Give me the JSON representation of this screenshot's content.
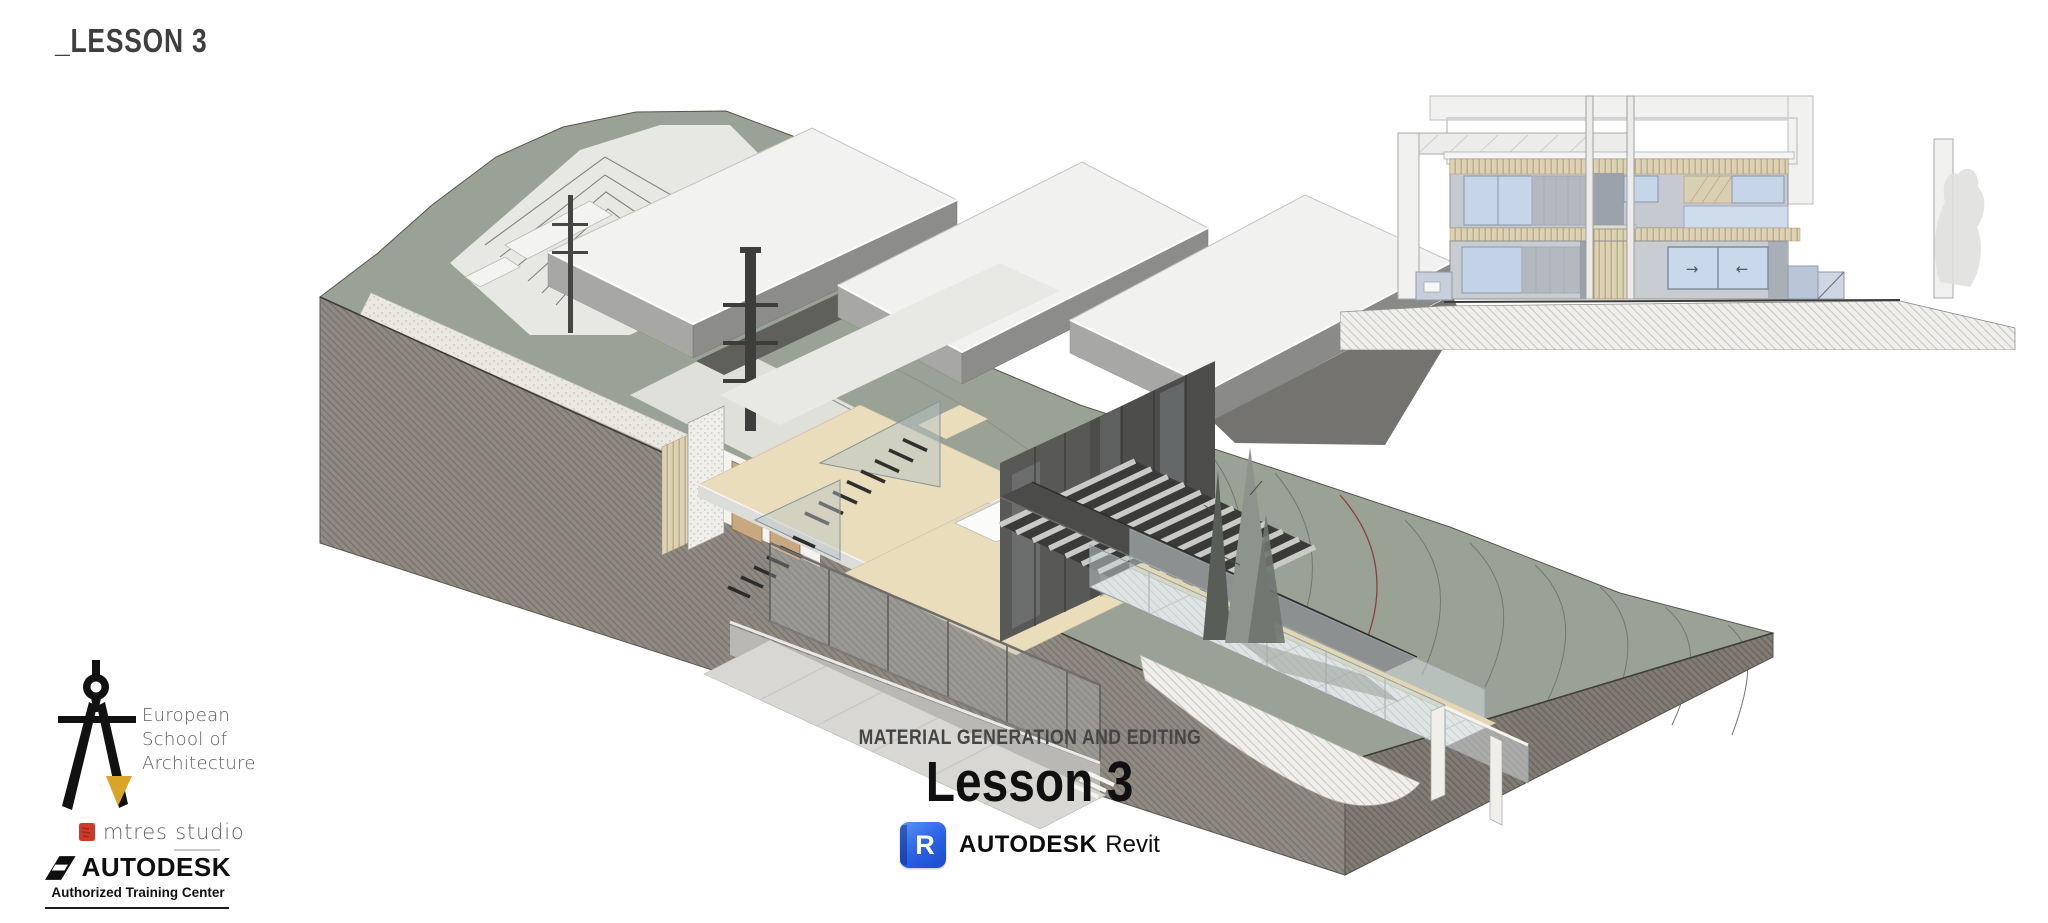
{
  "page": {
    "width": 2048,
    "height": 923,
    "background": "#ffffff"
  },
  "header": {
    "lesson_tag": "_LESSON 3"
  },
  "title_block": {
    "kicker": "MATERIAL GENERATION AND EDITING",
    "title": "Lesson 3",
    "software": {
      "icon": "revit-r-icon",
      "icon_letter": "R",
      "icon_color": "#2a63e8",
      "brand": "AUTODESK",
      "product": "Revit"
    }
  },
  "elevation": {
    "slider_arrows": [
      "→",
      "←"
    ]
  },
  "footer": {
    "school": {
      "icon": "drafting-compass-icon",
      "accent_color": "#d9a428",
      "lines": [
        "European",
        "School of",
        "Architecture"
      ]
    },
    "studio": {
      "icon": "red-square-icon",
      "icon_color": "#cf3a28",
      "name": "mtres studio"
    },
    "autodesk": {
      "icon": "autodesk-a-icon",
      "brand": "AUTODESK",
      "tagline": "Authorized Training Center"
    }
  },
  "artwork": {
    "colors": {
      "terrain_green": "#9aa296",
      "earth_gray": "#8d8880",
      "roof_white": "#f1f1ef",
      "wood_tan": "#e9ddbb",
      "glass_blue": "#c6d5e8",
      "contour_red": "#8a4038"
    }
  }
}
